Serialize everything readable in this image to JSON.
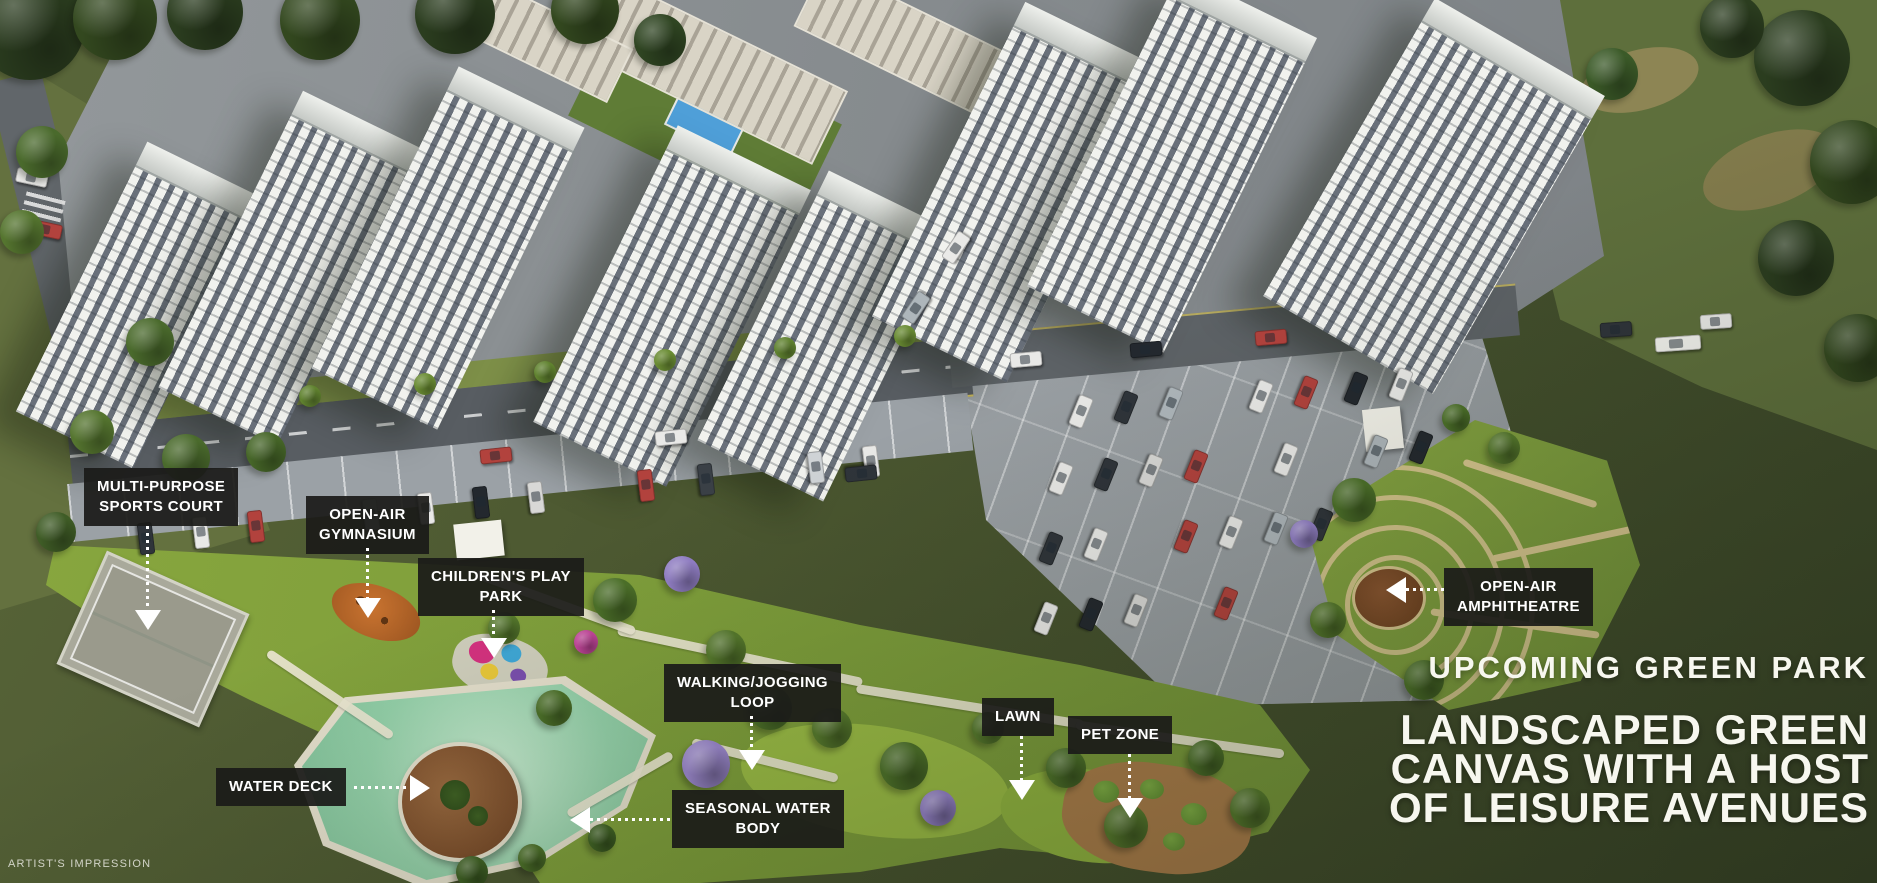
{
  "page": {
    "artist_note": "ARTIST'S IMPRESSION"
  },
  "headline": {
    "eyebrow": "UPCOMING GREEN PARK",
    "lines": [
      "LANDSCAPED GREEN",
      "CANVAS WITH A HOST",
      "OF LEISURE AVENUES"
    ]
  },
  "callouts": [
    {
      "name": "multi-purpose-sports-court",
      "lines": [
        "MULTI-PURPOSE",
        "SPORTS COURT"
      ]
    },
    {
      "name": "open-air-gymnasium",
      "lines": [
        "OPEN-AIR",
        "GYMNASIUM"
      ]
    },
    {
      "name": "childrens-play-park",
      "lines": [
        "CHILDREN'S PLAY",
        "PARK"
      ]
    },
    {
      "name": "walking-jogging-loop",
      "lines": [
        "WALKING/JOGGING",
        "LOOP"
      ]
    },
    {
      "name": "lawn",
      "lines": [
        "LAWN"
      ]
    },
    {
      "name": "pet-zone",
      "lines": [
        "PET ZONE"
      ]
    },
    {
      "name": "open-air-amphitheatre",
      "lines": [
        "OPEN-AIR",
        "AMPHITHEATRE"
      ]
    },
    {
      "name": "water-deck",
      "lines": [
        "WATER DECK"
      ]
    },
    {
      "name": "seasonal-water-body",
      "lines": [
        "SEASONAL WATER",
        "BODY"
      ]
    }
  ],
  "style": {
    "label_bg": "#1b1b19",
    "label_text": "#ffffff",
    "headline_text": "#f7f7ef",
    "water": "#93cfa8",
    "park_green": "#7c9c3a",
    "field_olive": "#45512d"
  },
  "scene": {
    "towers": [
      [
        140,
        305,
        130,
        300,
        26
      ],
      [
        290,
        268,
        132,
        330,
        26
      ],
      [
        448,
        248,
        140,
        336,
        26
      ],
      [
        672,
        306,
        148,
        330,
        26
      ],
      [
        826,
        336,
        140,
        300,
        26
      ],
      [
        1016,
        192,
        150,
        350,
        26
      ],
      [
        1172,
        162,
        152,
        350,
        26
      ],
      [
        1434,
        196,
        196,
        344,
        30
      ]
    ],
    "lowrises": [
      [
        705,
        66,
        270,
        78,
        26
      ],
      [
        912,
        44,
        230,
        66,
        26
      ],
      [
        540,
        36,
        170,
        56,
        26
      ]
    ],
    "trees": [
      [
        30,
        25,
        55,
        "#2b3d1f"
      ],
      [
        115,
        18,
        42,
        "#33481f"
      ],
      [
        205,
        12,
        38,
        "#2b3d1f"
      ],
      [
        320,
        20,
        40,
        "#33481f"
      ],
      [
        455,
        14,
        40,
        "#2b3d1f"
      ],
      [
        585,
        10,
        34,
        "#33481f"
      ],
      [
        660,
        40,
        26,
        "#2f4522"
      ],
      [
        1802,
        58,
        48,
        "#2b3d1f"
      ],
      [
        1852,
        162,
        42,
        "#33481f"
      ],
      [
        1796,
        258,
        38,
        "#2b3d1f"
      ],
      [
        1858,
        348,
        34,
        "#33481f"
      ],
      [
        1732,
        26,
        32,
        "#2b3d1f"
      ],
      [
        1612,
        74,
        26,
        "#3b5a28"
      ],
      [
        42,
        152,
        26,
        "#4a6a2c"
      ],
      [
        22,
        232,
        22,
        "#55752f"
      ],
      [
        150,
        342,
        24,
        "#4a6a2c"
      ],
      [
        92,
        432,
        22,
        "#55752f"
      ],
      [
        186,
        458,
        24,
        "#4a6a2c"
      ],
      [
        266,
        452,
        20,
        "#466628"
      ],
      [
        56,
        532,
        20,
        "#3f5c26"
      ],
      [
        310,
        396,
        11,
        "#60822f"
      ],
      [
        425,
        384,
        11,
        "#6a8c33"
      ],
      [
        545,
        372,
        11,
        "#60822f"
      ],
      [
        665,
        360,
        11,
        "#6a8c33"
      ],
      [
        785,
        348,
        11,
        "#60822f"
      ],
      [
        905,
        336,
        11,
        "#6a8c33"
      ],
      [
        615,
        600,
        22,
        "#4c7029"
      ],
      [
        682,
        574,
        18,
        "#927fc6"
      ],
      [
        726,
        650,
        20,
        "#55782c"
      ],
      [
        770,
        708,
        22,
        "#4c7029"
      ],
      [
        706,
        764,
        24,
        "#9a86cc"
      ],
      [
        832,
        728,
        20,
        "#55782c"
      ],
      [
        904,
        766,
        24,
        "#4c7029"
      ],
      [
        938,
        808,
        18,
        "#927fc6"
      ],
      [
        988,
        728,
        16,
        "#55782c"
      ],
      [
        1066,
        768,
        20,
        "#4c7029"
      ],
      [
        1126,
        826,
        22,
        "#55782c"
      ],
      [
        1206,
        758,
        18,
        "#4c7029"
      ],
      [
        1250,
        808,
        20,
        "#55782c"
      ],
      [
        554,
        708,
        18,
        "#4c7029"
      ],
      [
        504,
        628,
        16,
        "#55782c"
      ],
      [
        472,
        872,
        16,
        "#3f6124"
      ],
      [
        532,
        858,
        14,
        "#4c7029"
      ],
      [
        602,
        838,
        14,
        "#3f6124"
      ],
      [
        586,
        642,
        12,
        "#c2459a"
      ],
      [
        1354,
        500,
        22,
        "#4c7029"
      ],
      [
        1328,
        620,
        18,
        "#55782c"
      ],
      [
        1424,
        680,
        20,
        "#4c7029"
      ],
      [
        1504,
        448,
        16,
        "#55782c"
      ],
      [
        1304,
        534,
        14,
        "#927fc6"
      ],
      [
        1456,
        418,
        14,
        "#4c7029"
      ]
    ],
    "cars": [
      [
        130,
        531,
        83,
        "#2f343a"
      ],
      [
        185,
        525,
        83,
        "#e9e9e7"
      ],
      [
        240,
        519,
        83,
        "#b2423d"
      ],
      [
        355,
        507,
        83,
        "#aeb6bb"
      ],
      [
        410,
        501,
        83,
        "#e9e9e7"
      ],
      [
        465,
        495,
        83,
        "#23282e"
      ],
      [
        520,
        490,
        83,
        "#d8d8d6"
      ],
      [
        630,
        478,
        83,
        "#b2423d"
      ],
      [
        690,
        472,
        83,
        "#3a4046"
      ],
      [
        800,
        460,
        83,
        "#cfd3d6"
      ],
      [
        855,
        454,
        83,
        "#e9e9e7"
      ],
      [
        480,
        448,
        -6,
        "#b2423d"
      ],
      [
        655,
        430,
        -6,
        "#e9e9e7"
      ],
      [
        845,
        466,
        174,
        "#2f343a"
      ],
      [
        1010,
        352,
        -5,
        "#e9e9e7"
      ],
      [
        1130,
        342,
        -5,
        "#23282e"
      ],
      [
        1255,
        330,
        -5,
        "#b2423d"
      ],
      [
        1600,
        322,
        -4,
        "#2f343a"
      ],
      [
        1700,
        314,
        -4,
        "#e9e9e7"
      ],
      [
        1655,
        336,
        -4,
        "#f2f2ee",
        44
      ],
      [
        900,
        300,
        -56,
        "#aeb6bb"
      ],
      [
        940,
        240,
        -56,
        "#e9e9e7"
      ],
      [
        1065,
        404,
        112,
        "#e9e9e7"
      ],
      [
        1110,
        400,
        112,
        "#2f343a"
      ],
      [
        1155,
        396,
        112,
        "#aeb6bb"
      ],
      [
        1245,
        389,
        112,
        "#e9e9e7"
      ],
      [
        1290,
        385,
        112,
        "#b2423d"
      ],
      [
        1340,
        381,
        112,
        "#23282e"
      ],
      [
        1385,
        377,
        112,
        "#e9e9e7"
      ],
      [
        1045,
        471,
        112,
        "#e9e9e7"
      ],
      [
        1090,
        467,
        112,
        "#2f343a"
      ],
      [
        1135,
        463,
        112,
        "#d8d8d6"
      ],
      [
        1180,
        459,
        112,
        "#b2423d"
      ],
      [
        1270,
        452,
        112,
        "#e9e9e7"
      ],
      [
        1360,
        444,
        112,
        "#aeb6bb"
      ],
      [
        1405,
        440,
        112,
        "#23282e"
      ],
      [
        1035,
        541,
        112,
        "#2f343a"
      ],
      [
        1080,
        537,
        112,
        "#e9e9e7"
      ],
      [
        1170,
        529,
        112,
        "#b2423d"
      ],
      [
        1215,
        525,
        112,
        "#e9e9e7"
      ],
      [
        1260,
        521,
        112,
        "#aeb6bb"
      ],
      [
        1305,
        517,
        112,
        "#2f343a"
      ],
      [
        1030,
        611,
        112,
        "#e9e9e7"
      ],
      [
        1075,
        607,
        112,
        "#23282e"
      ],
      [
        1120,
        603,
        112,
        "#d8d8d6"
      ],
      [
        1210,
        596,
        112,
        "#b2423d"
      ],
      [
        30,
        222,
        12,
        "#b2423d"
      ],
      [
        16,
        170,
        12,
        "#e9e9e7"
      ]
    ]
  }
}
